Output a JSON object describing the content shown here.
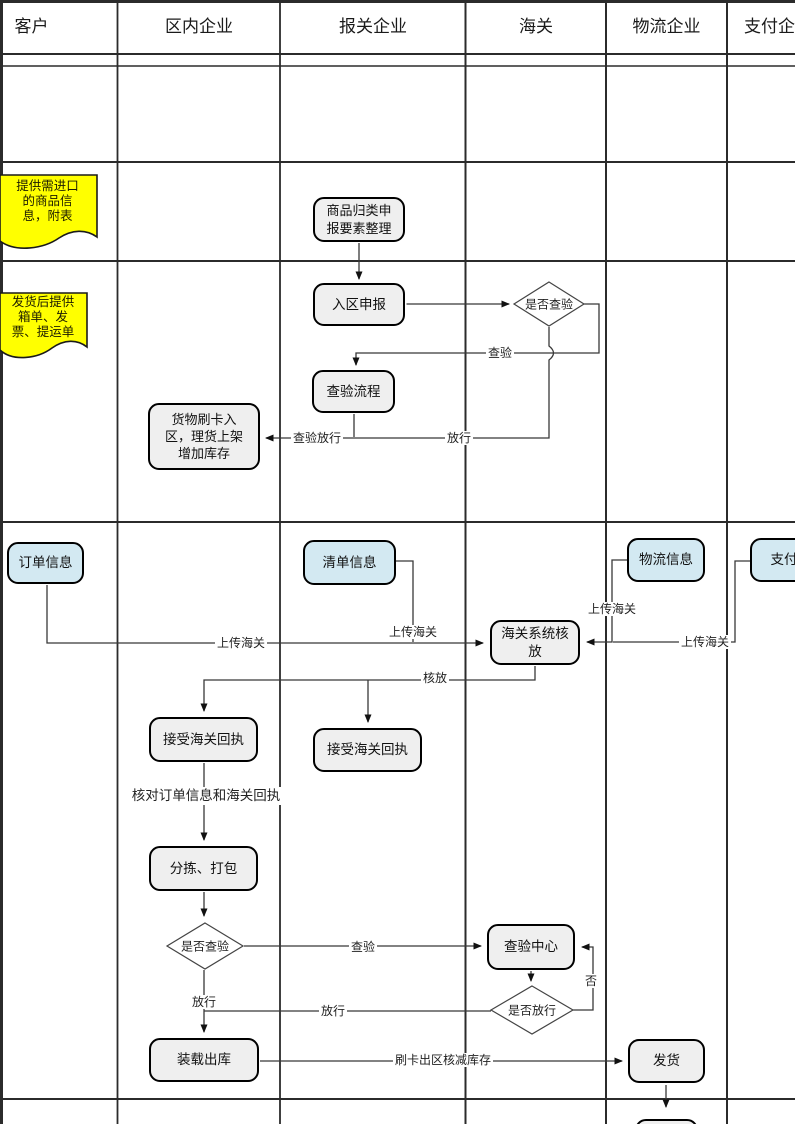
{
  "header": {
    "columns": [
      "客户",
      "区内企业",
      "报关企业",
      "海关",
      "物流企业",
      "支付企业"
    ]
  },
  "notes": [
    {
      "text": "提供需进口\n的商品信\n息，附表"
    },
    {
      "text": "发货后提供\n箱单、发\n票、提运单"
    }
  ],
  "data_boxes": [
    {
      "label": "订单信息"
    },
    {
      "label": "清单信息"
    },
    {
      "label": "物流信息"
    },
    {
      "label": "支付信息"
    }
  ],
  "processes": [
    {
      "label": "商品归类申\n报要素整理"
    },
    {
      "label": "入区申报"
    },
    {
      "label": "查验流程"
    },
    {
      "label": "货物刷卡入\n区，理货上架\n增加库存"
    },
    {
      "label": "海关系统核\n放"
    },
    {
      "label": "接受海关回执"
    },
    {
      "label": "接受海关回执"
    },
    {
      "label": "分拣、打包"
    },
    {
      "label": "查验中心"
    },
    {
      "label": "装载出库"
    },
    {
      "label": "发货"
    }
  ],
  "decisions": [
    {
      "label": "是否查验"
    },
    {
      "label": "是否查验"
    },
    {
      "label": "是否放行"
    }
  ],
  "edge_labels": {
    "inspect_top": "查验",
    "release_top": "放行",
    "inspect_release": "查验放行",
    "upload_customs_order": "上传海关",
    "upload_customs_list": "上传海关",
    "upload_customs_logistics": "上传海关",
    "upload_customs_payment": "上传海关",
    "verify_release": "核放",
    "inspect_bottom": "查验",
    "release_vertical": "放行",
    "release_horizontal": "放行",
    "no": "否",
    "swipe_out": "刷卡出区核减库存",
    "check_note": "核对订单信息和海关回执"
  },
  "colors": {
    "note_fill": "#ffff00",
    "data_box_fill": "#d3e9f2",
    "process_fill": "#efefef",
    "diamond_fill": "#ffffff",
    "line": "#333333"
  }
}
